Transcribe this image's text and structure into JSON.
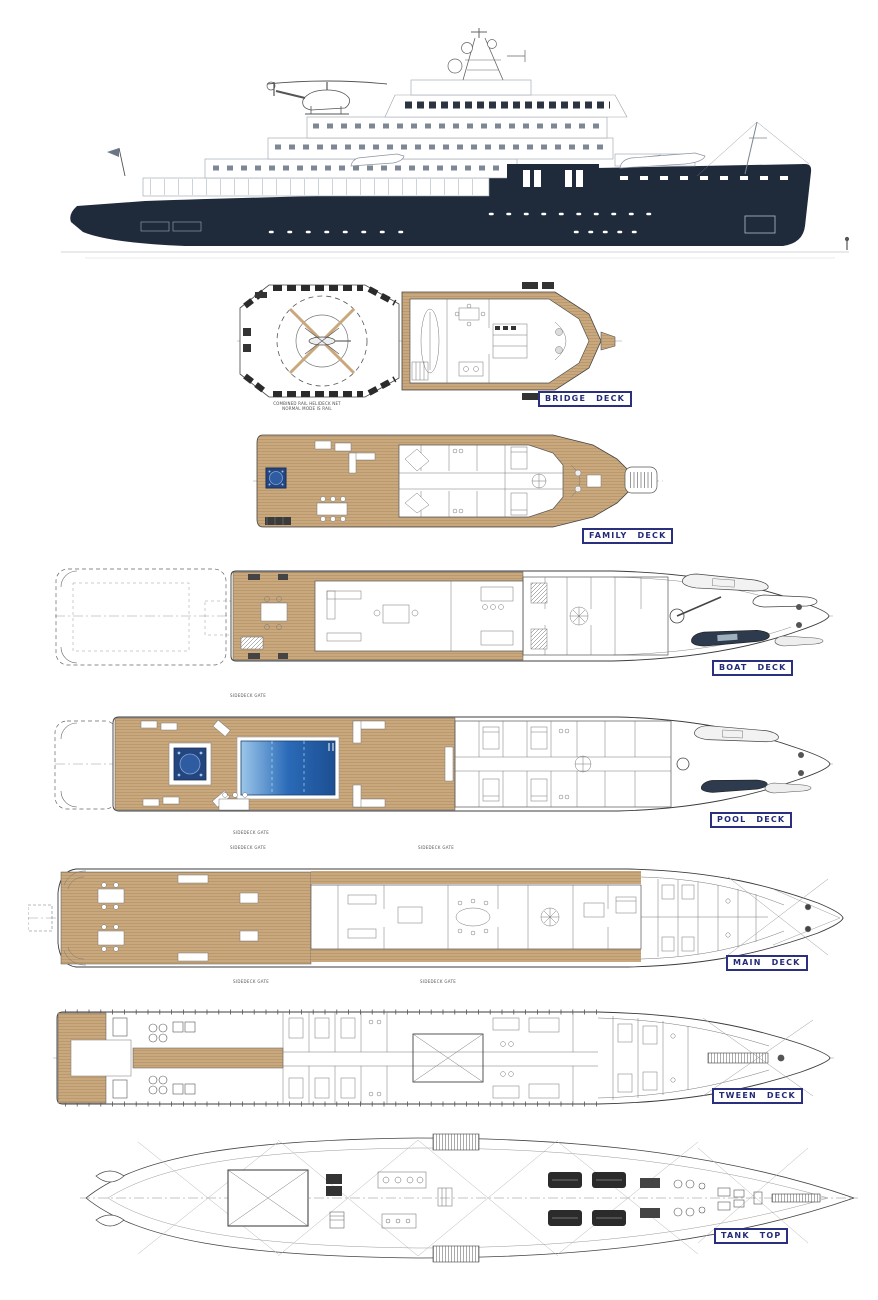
{
  "page": {
    "background": "#ffffff"
  },
  "colors": {
    "hull_navy": "#1f2a3a",
    "teak": "#c9a87e",
    "teak_line": "#ad8a5f",
    "pool_light": "#9cc7ea",
    "pool_dark": "#1d4f92",
    "jacuzzi_blue": "#24457e",
    "label_ink": "#232a78",
    "line_dark": "#3c3c3c"
  },
  "profile": {
    "name": "side-profile-rendering"
  },
  "decks": [
    {
      "id": "bridge-deck",
      "label": "BRIDGE  DECK",
      "note_line1": "COMBINED RAIL HELIDECK NET",
      "note_line2": "NORMAL MODE IS RAIL"
    },
    {
      "id": "family-deck",
      "label": "FAMILY  DECK"
    },
    {
      "id": "boat-deck",
      "label": "BOAT  DECK"
    },
    {
      "id": "pool-deck",
      "label": "POOL  DECK",
      "gates": [
        "SIDEDECK GATE",
        "SIDEDECK GATE"
      ]
    },
    {
      "id": "main-deck",
      "label": "MAIN  DECK",
      "gates": [
        "SIDEDECK GATE",
        "SIDEDECK GATE",
        "SIDEDECK GATE",
        "SIDEDECK GATE"
      ]
    },
    {
      "id": "tween-deck",
      "label": "TWEEN  DECK"
    },
    {
      "id": "tank-top",
      "label": "TANK  TOP"
    }
  ]
}
